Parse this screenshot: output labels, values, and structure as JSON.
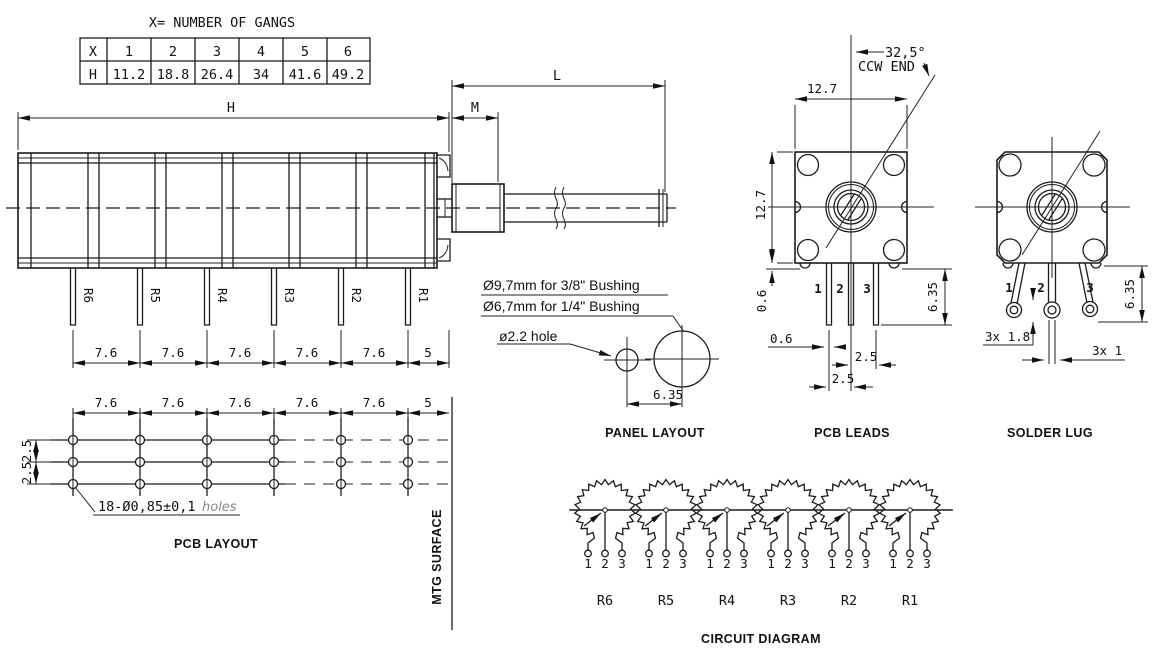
{
  "table": {
    "title": "X= NUMBER OF GANGS",
    "x_label": "X",
    "h_label": "H",
    "gangs": [
      "1",
      "2",
      "3",
      "4",
      "5",
      "6"
    ],
    "heights": [
      "11.2",
      "18.8",
      "26.4",
      "34",
      "41.6",
      "49.2"
    ]
  },
  "side_view": {
    "dim_h": "H",
    "dim_m": "M",
    "dim_l": "L",
    "pin_labels": [
      "R6",
      "R5",
      "R4",
      "R3",
      "R2",
      "R1"
    ],
    "pitches": [
      "7.6",
      "7.6",
      "7.6",
      "7.6",
      "7.6"
    ],
    "end_pitch": "5"
  },
  "pcb_layout": {
    "title": "PCB LAYOUT",
    "pitches": [
      "7.6",
      "7.6",
      "7.6",
      "7.6",
      "7.6"
    ],
    "end_pitch": "5",
    "row_pitches": [
      "2.5",
      "2.5"
    ],
    "holes_note": "18-Ø0,85±0,1",
    "holes_suffix": "holes",
    "mtg": "MTG SURFACE"
  },
  "panel_layout": {
    "title": "PANEL LAYOUT",
    "note1": "Ø9,7mm for 3/8\" Bushing",
    "note2": "Ø6,7mm for 1/4\" Bushing",
    "hole_note": "ø2.2  hole",
    "dim": "6.35"
  },
  "pcb_leads": {
    "title": "PCB LEADS",
    "angle": "32,5°",
    "ccw": "CCW END",
    "dim_top": "12.7",
    "dim_left": "12.7",
    "dim_nub": "0.6",
    "dim_pin_w": "0.6",
    "dim_p23": "2.5",
    "dim_p12": "2.5",
    "dim_len": "6.35",
    "pins": [
      "1",
      "2",
      "3"
    ]
  },
  "solder_lug": {
    "title": "SOLDER LUG",
    "dim_hole": "3x  1.8",
    "dim_w": "3x  1",
    "dim_len": "6.35",
    "pins": [
      "1",
      "2",
      "3"
    ]
  },
  "circuit": {
    "title": "CIRCUIT DIAGRAM",
    "pots": [
      "R6",
      "R5",
      "R4",
      "R3",
      "R2",
      "R1"
    ],
    "terminals": [
      "1",
      "2",
      "3"
    ]
  }
}
